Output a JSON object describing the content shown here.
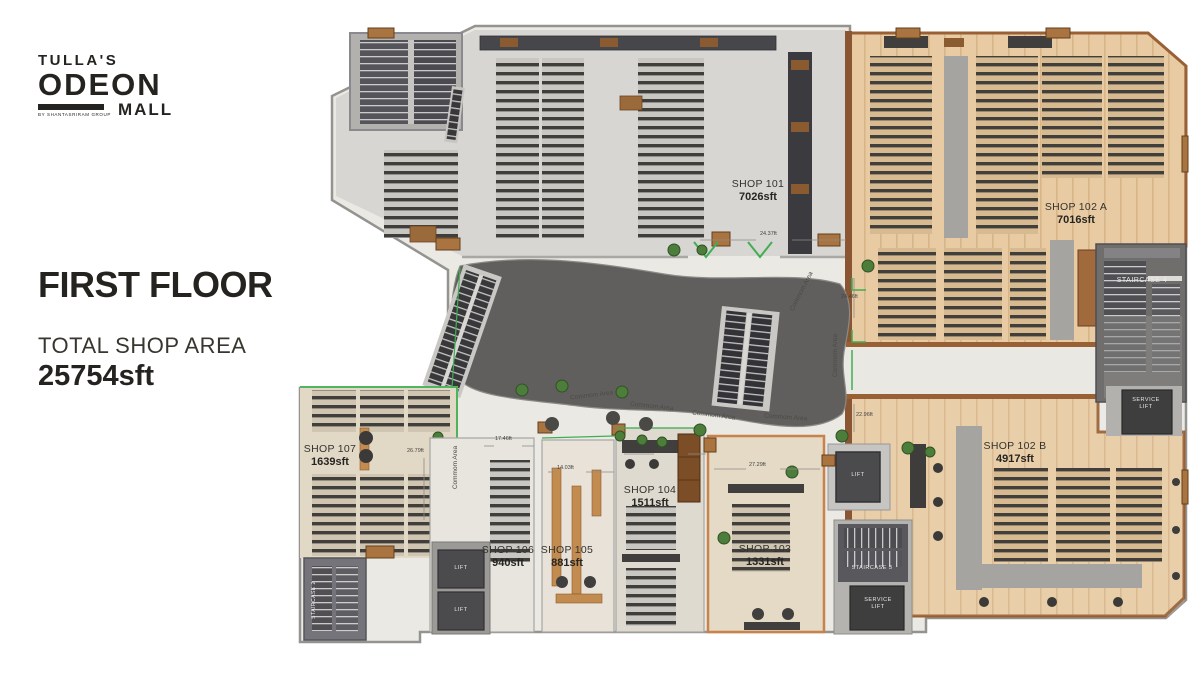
{
  "branding": {
    "name_line1": "TULLA'S",
    "name_line2": "ODEON",
    "name_line3": "MALL",
    "byline": "BY SHANTASRIRAM GROUP"
  },
  "header": {
    "title": "FIRST FLOOR",
    "subtitle": "TOTAL SHOP AREA",
    "total_area": "25754sft"
  },
  "shops": [
    {
      "name": "SHOP 101",
      "area": "7026sft"
    },
    {
      "name": "SHOP 102 A",
      "area": "7016sft"
    },
    {
      "name": "SHOP 102 B",
      "area": "4917sft"
    },
    {
      "name": "SHOP 103",
      "area": "1331sft"
    },
    {
      "name": "SHOP 104",
      "area": "1511sft"
    },
    {
      "name": "SHOP 105",
      "area": "881sft"
    },
    {
      "name": "SHOP 106",
      "area": "940sft"
    },
    {
      "name": "SHOP 107",
      "area": "1639sft"
    }
  ],
  "facilities": {
    "staircase2": "STAIRCASE 2",
    "staircase3": "STAIRCASE 3",
    "staircase4": "STAIRCASE 4",
    "lift": "LIFT",
    "service": "SERVICE"
  },
  "labels": {
    "common_area": "Commom Area"
  },
  "dimensions": [
    "24.37ft",
    "24.46ft",
    "22.96ft",
    "26.79ft",
    "17.46ft",
    "14.03ft",
    "25.12ft",
    "27.29ft"
  ],
  "colors": {
    "wood_floor": "#e8cba2",
    "wood_wall": "#9a6035",
    "marble": "#ebe9e4",
    "atrium_gray": "#605f5d",
    "accent_green": "#3fae52",
    "text_dark": "#262522"
  }
}
